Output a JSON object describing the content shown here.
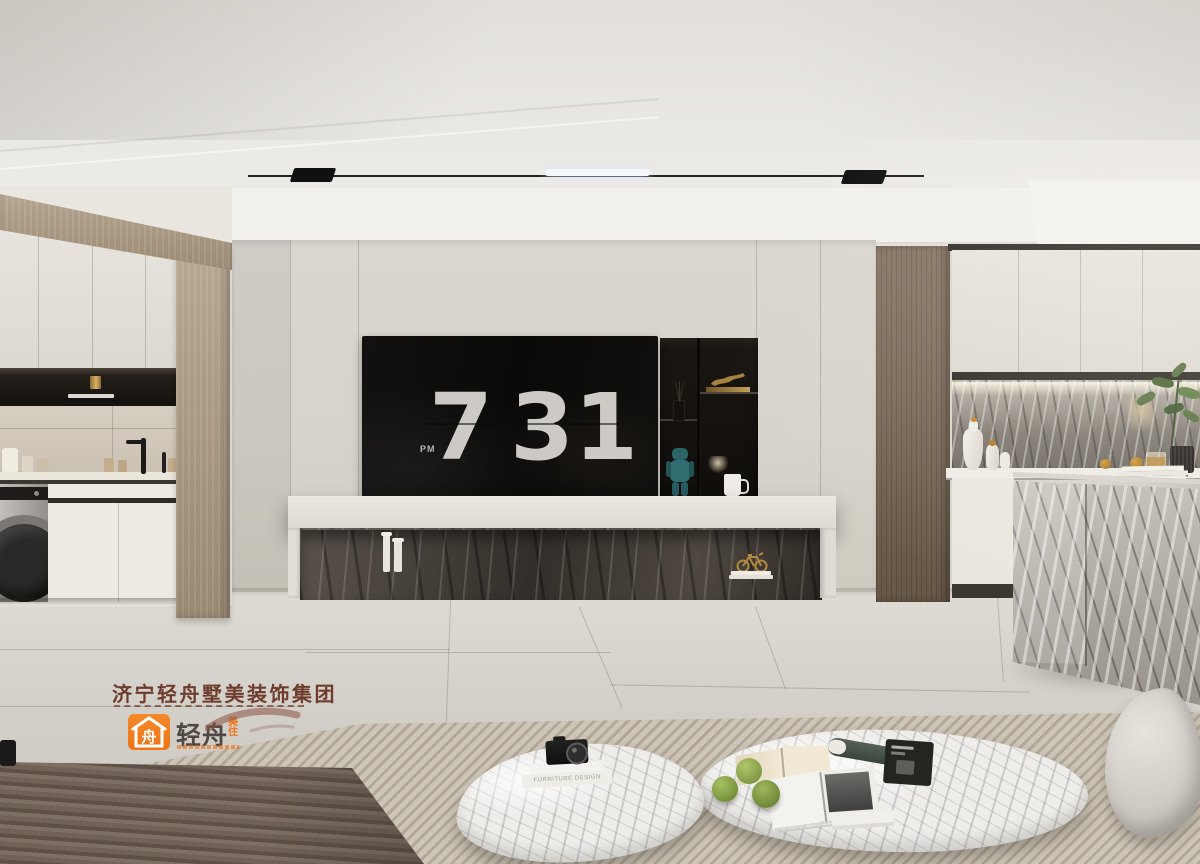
{
  "scene": {
    "type": "interior-render",
    "description": "Modern minimalist living room with TV wall flip clock, open kitchen and marble island"
  },
  "tv_clock": {
    "hour": "7",
    "minute": "31",
    "meridiem": "PM"
  },
  "watermark": {
    "company": "济宁轻舟墅美装饰集团",
    "brand": "轻舟",
    "brand_sub_top": "美",
    "brand_sub_bottom": "住",
    "logo_glyph": "舟"
  },
  "coffee_table": {
    "book_spine": "FURNITURE DESIGN"
  },
  "icons": {
    "logo": "house-boat-icon",
    "shelf_sculpture": "brass-animal-figurine",
    "plinth_sculpture": "gold-bicycle-figurine",
    "shelf_toy": "teal-bear-figure"
  },
  "colors": {
    "brand_orange": "#ef7315",
    "watermark_text": "#6e3c2c",
    "wall": "#d8d4cc",
    "floor": "#d2cfc8",
    "sofa": "#6e6156",
    "rug": "#c7bfb0",
    "wood_light": "#a7977f",
    "wood_dark": "#74654f",
    "clock_digits": "#cdcac5"
  }
}
